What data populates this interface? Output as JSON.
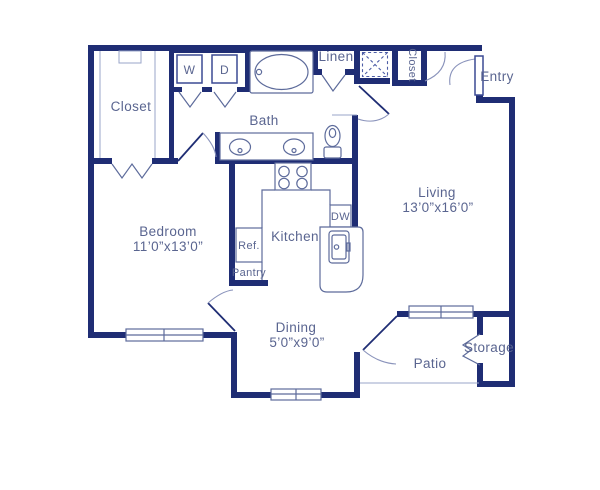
{
  "title": "One-bedroom apartment floor plan",
  "colors": {
    "wall": "#1f2d74",
    "fixture_line": "#5d6b9b",
    "light_line": "#9aa5c8",
    "door_arc": "#8a93bb",
    "text": "#5a6590",
    "background": "#ffffff"
  },
  "rooms": {
    "closet_main": {
      "label": "Closet"
    },
    "bedroom": {
      "label": "Bedroom",
      "dims": "11’0”x13’0”"
    },
    "bath": {
      "label": "Bath"
    },
    "linen": {
      "label": "Linen"
    },
    "entry_closet": {
      "label": "Closet"
    },
    "entry": {
      "label": "Entry"
    },
    "living": {
      "label": "Living",
      "dims": "13’0”x16’0”"
    },
    "kitchen": {
      "label": "Kitchen"
    },
    "pantry": {
      "label": "Pantry"
    },
    "dining": {
      "label": "Dining",
      "dims": "5’0”x9’0”"
    },
    "patio": {
      "label": "Patio"
    },
    "storage": {
      "label": "Storage"
    }
  },
  "appliances": {
    "washer": "W",
    "dryer": "D",
    "dishwasher": "DW",
    "refrigerator": "Ref."
  }
}
